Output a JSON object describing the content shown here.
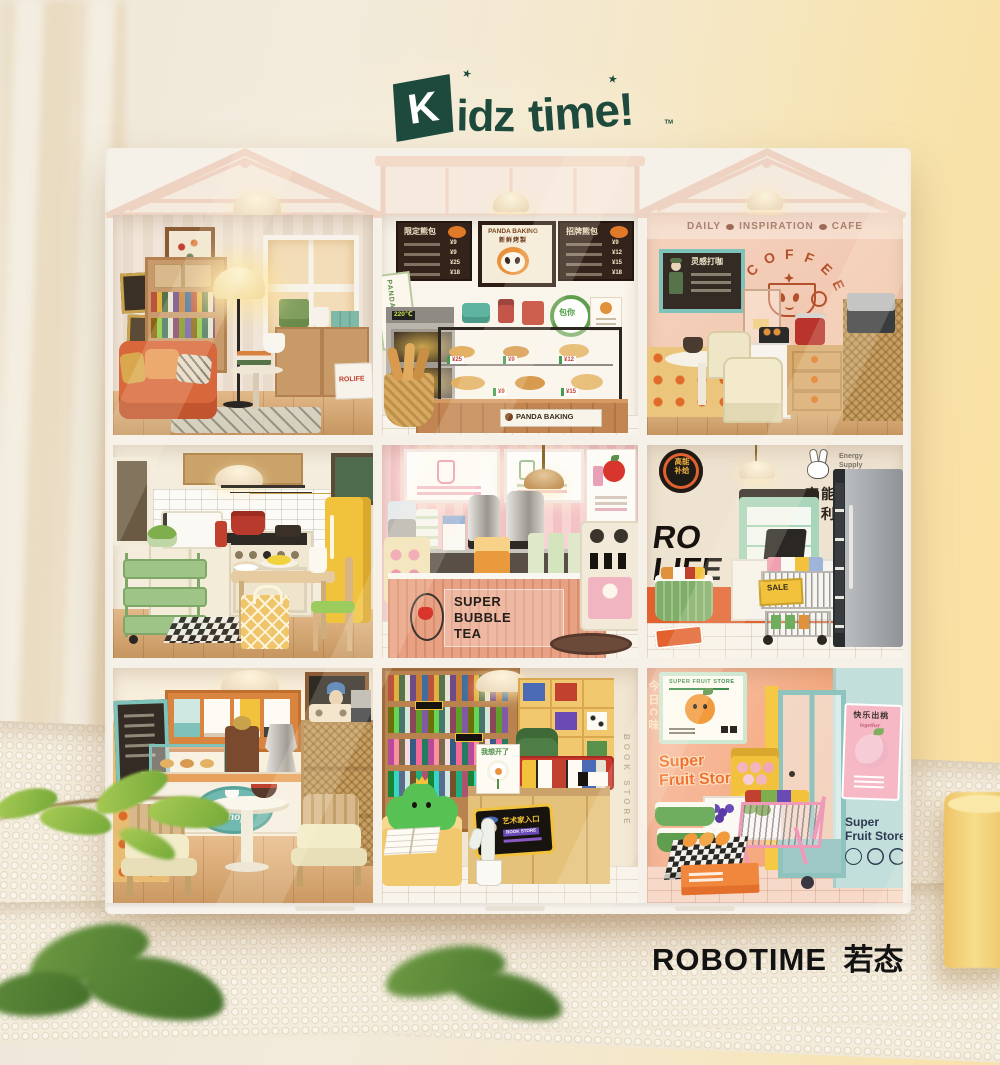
{
  "colors": {
    "logo_green": "#1d4a3c",
    "brand_black": "#141414",
    "cafe_rust": "#b5502e",
    "bakery_board_brown": "#33231b",
    "bubble_tea_pink": "#f3c6c8",
    "market_orange": "#e2612f",
    "sale_yellow": "#f2c23c",
    "fruit_orange": "#f07030",
    "frame_white": "#f5f0e8"
  },
  "logo": {
    "k": "K",
    "idz": "idz",
    "time": "time!",
    "tm": "TM",
    "star": "★"
  },
  "brand": {
    "name": "ROBOTIME",
    "cn": "若态"
  },
  "rooms": {
    "living": {
      "rolife_box": "ROLIFE"
    },
    "bakery": {
      "menu_left_title": "限定熊包",
      "menu_left_prices": [
        "¥9",
        "¥9",
        "¥25",
        "¥18"
      ],
      "menu_center_title": "PANDA BAKING",
      "menu_center_sub": "新鲜烤製",
      "menu_right_title": "招牌熊包",
      "menu_right_prices": [
        "¥9",
        "¥12",
        "¥15",
        "¥18"
      ],
      "side_sign": "PANDA BAKING",
      "round_sign": "包你",
      "counter_sign": "PANDA BAKING",
      "oven_display": "220℃",
      "case_tags": [
        "¥25",
        "¥9",
        "¥12",
        "¥9",
        "¥15"
      ]
    },
    "cafe": {
      "glass_word_1": "DAILY",
      "glass_word_2": "INSPIRATION",
      "glass_word_3": "CAFE",
      "wall_art_i": "I",
      "wall_art_letters": [
        "C",
        "O",
        "F",
        "F",
        "E",
        "E"
      ],
      "menu_title": "灵感打咖"
    },
    "bubble_tea": {
      "sign_line_1": "SUPER",
      "sign_line_2": "BUBBLE",
      "sign_line_3": "TEA"
    },
    "market": {
      "badge_text": "高能补给",
      "logo_en_1": "Energy",
      "logo_en_2": "Supply",
      "logo_en_3": "Store",
      "cn_line_1": "高能补给",
      "cn_line_2": "便利店",
      "wall_line_1": "RO",
      "wall_line_2": "LIFE",
      "sale_tag": "SALE"
    },
    "coffee_shop": {
      "sign_line_1": "coffee",
      "sign_line_2": "shop"
    },
    "book_store": {
      "sign": "Book Store",
      "poster": "我想开了",
      "entrance_sign": "艺术家入口",
      "entrance_sub": "BOOK STORE",
      "wall_vertical": "BOOK STORE"
    },
    "fruit": {
      "poster_header": "SUPER FRUIT STORE",
      "wall_line_1": "Super",
      "wall_line_2": "Fruit Store",
      "peach_poster_title": "快乐出桃",
      "peach_poster_sub": "together",
      "side_line_1": "Super",
      "side_line_2": "Fruit Store",
      "left_vertical": "今日C味"
    }
  }
}
